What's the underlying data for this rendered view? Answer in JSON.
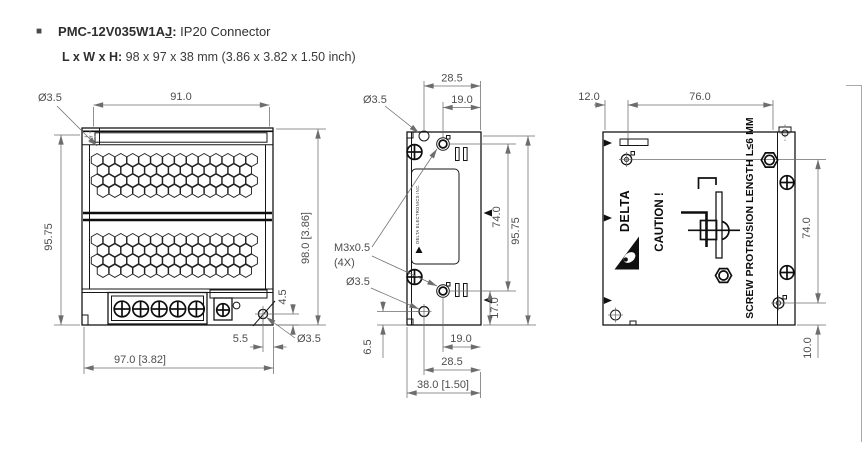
{
  "colors": {
    "drawing_line": "#161616",
    "dimension_line": "#6d6d6d",
    "dimension_text": "#4d4d4d",
    "title_text": "#2e2e2e"
  },
  "header": {
    "bullet": "■",
    "model": "PMC-12V035W1A",
    "model_suffix": "J",
    "colon": ":",
    "connector_type": " IP20 Connector",
    "size_label": "L x W x H:",
    "size_value": " 98 x 97 x 38 mm (3.86 x 3.82 x 1.50 inch)"
  },
  "front_view": {
    "hole_dia_top": "Ø3.5",
    "width_top": "91.0",
    "height_left": "95.75",
    "height_right": "98.0 [3.86]",
    "hole_offset_v": "4.5",
    "hole_offset_h": "5.5",
    "hole_dia_bottom": "Ø3.5",
    "width_bottom": "97.0 [3.82]"
  },
  "side_view": {
    "depth_top": "28.5",
    "hole_offset_top": "19.0",
    "hole_dia_top": "Ø3.5",
    "thread_spec": "M3x0.5",
    "thread_qty": "(4X)",
    "hole_dia_bottom": "Ø3.5",
    "hole_offset_left": "6.5",
    "hole_offset_right": "17.0",
    "hole_spacing": "74.0",
    "height_right": "95.75",
    "hole_offset_bottom": "19.0",
    "hole_offset_bottom2": "28.5",
    "depth_bottom": "38.0 [1.50]",
    "unit_label": "DELTA ELECTRONICS INC."
  },
  "back_view": {
    "offset_top": "12.0",
    "width_top": "76.0",
    "brand": "DELTA",
    "caution_text": "CAUTION !",
    "protrusion_note": "SCREW PROTRUSION LENGTH L≤6 MM",
    "hole_spacing": "74.0",
    "hole_offset_bottom": "10.0"
  }
}
